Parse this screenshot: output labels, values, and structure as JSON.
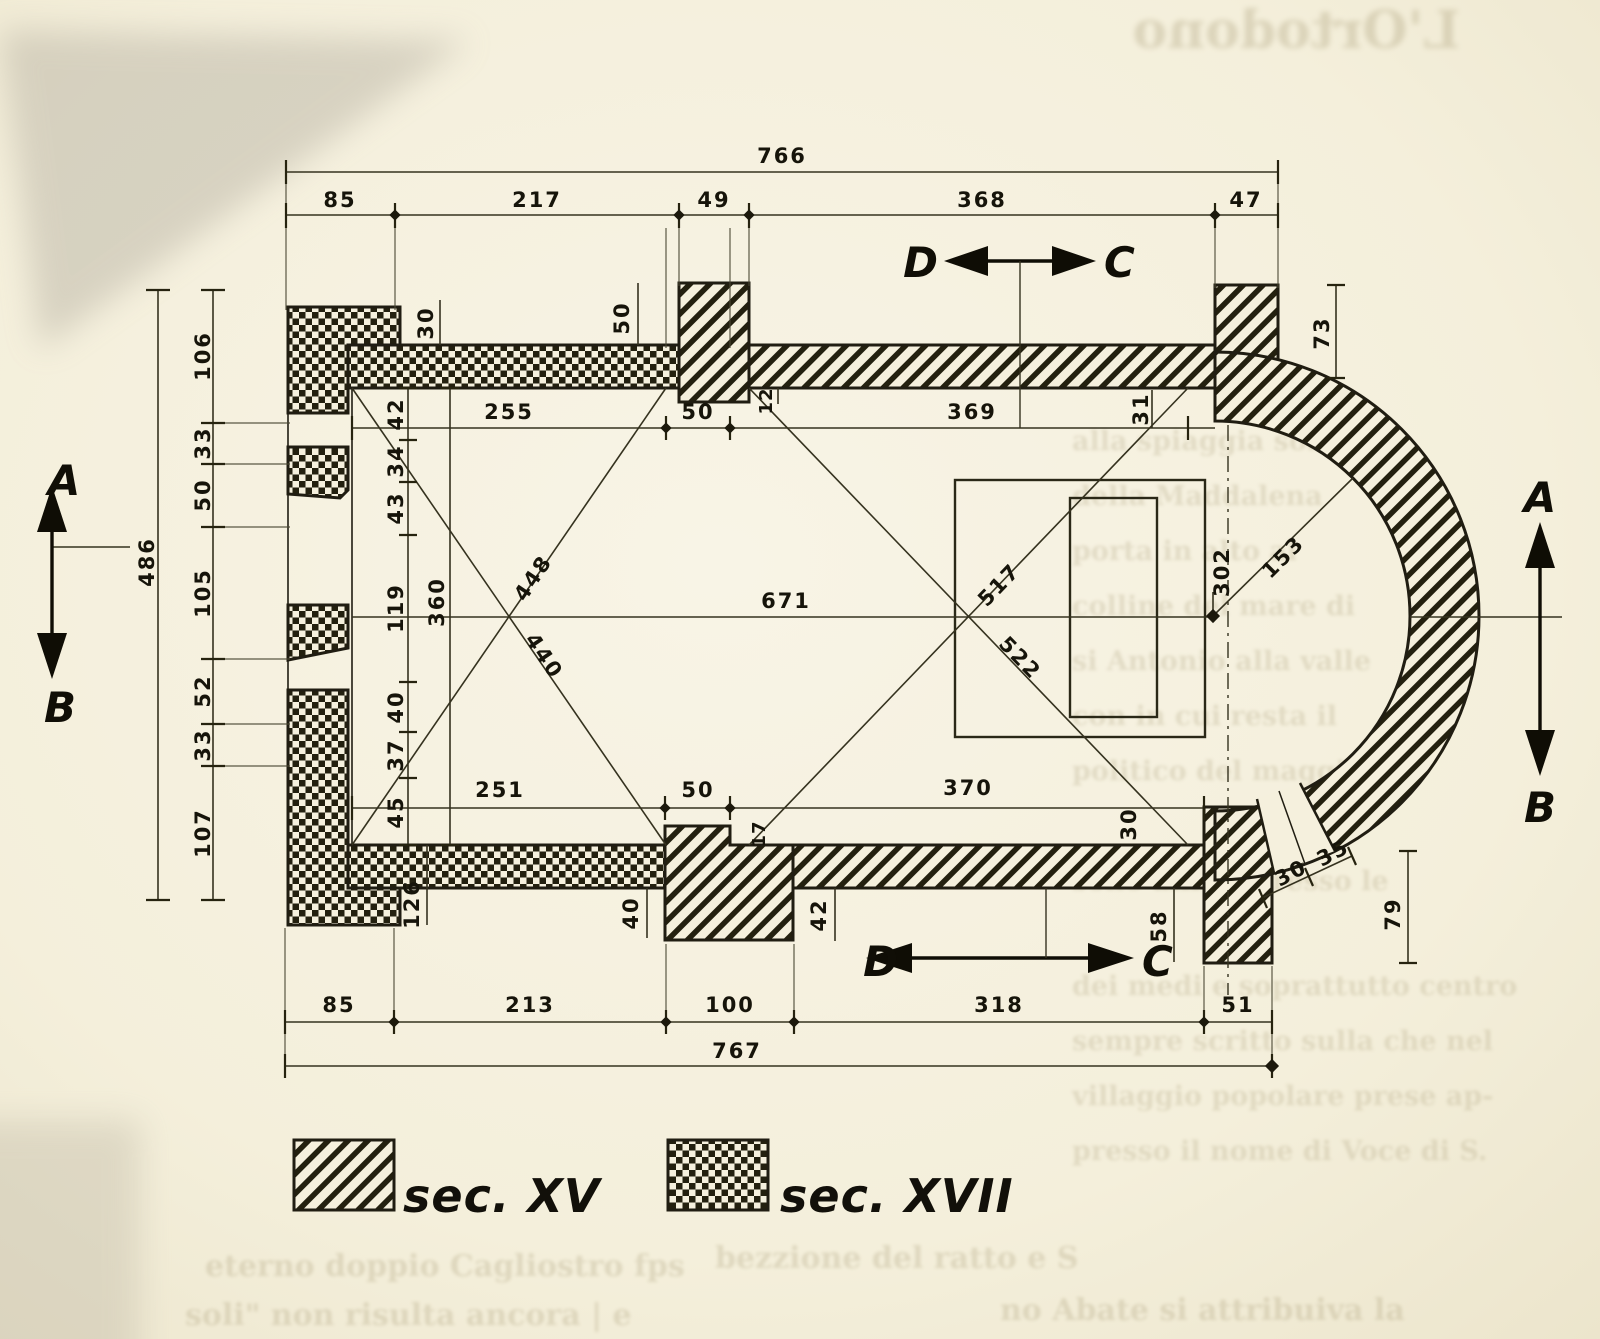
{
  "figure": {
    "kind": "measured floor plan of a single-nave church with semicircular apse",
    "units_note": "all numbers are survey measurements"
  },
  "colors": {
    "paper": "#f5f0dd",
    "ink": "#201d12",
    "dim_line": "#35321f",
    "bleed_text": "#9d9068"
  },
  "sections": {
    "a": "A",
    "b": "B",
    "c": "C",
    "d": "D"
  },
  "legend": {
    "xv_label": "sec. XV",
    "xvii_label": "sec. XVII"
  },
  "dims": {
    "top_total": "766",
    "top": [
      "85",
      "217",
      "49",
      "368",
      "47"
    ],
    "left_total": "486",
    "left": [
      "106",
      "33",
      "50",
      "105",
      "52",
      "33",
      "107"
    ],
    "bottom": [
      "85",
      "213",
      "100",
      "318",
      "51"
    ],
    "bottom_total": "767",
    "nave_top": [
      "255",
      "50",
      "369"
    ],
    "step_top": "12",
    "apse_gap_top": "31",
    "buttress_top": "30",
    "pilaster_top": "50",
    "chain": [
      "42",
      "34",
      "43",
      "119",
      "40",
      "37",
      "45"
    ],
    "nave_width": "360",
    "nave_length": "671",
    "diagonals_left": [
      "448",
      "440"
    ],
    "diagonals_right": [
      "517",
      "522"
    ],
    "apse_width": "302",
    "apse_radius": "153",
    "apse_pilaster": "73",
    "apse_outer": "79",
    "apse_window": [
      "30",
      "35"
    ],
    "nave_bottom": [
      "251",
      "50",
      "370"
    ],
    "step_bottom": "17",
    "pier_bottom": "30",
    "protrusions": [
      "126",
      "40",
      "42",
      "58"
    ]
  },
  "bleedthrough": {
    "heading": "L'Ortodono",
    "right_column": [
      "alla spiaggia son",
      "della Maddalena",
      "porta in alto al",
      "colline del mare di",
      "si Antonio alla valle",
      "con in cui resta il",
      "politico del maggio",
      "sono allievi presso le",
      "dei medi e soprattutto centro",
      "sempre scritto sulla che nel",
      "villaggio popolare prese ap-",
      "presso il nome di Voce di S."
    ],
    "bottom": [
      "eterno doppio Cagliostro fps",
      "bezzione del ratto e S",
      "soli\" non risulta ancora | e",
      "no Abate si attribuiva la"
    ]
  }
}
